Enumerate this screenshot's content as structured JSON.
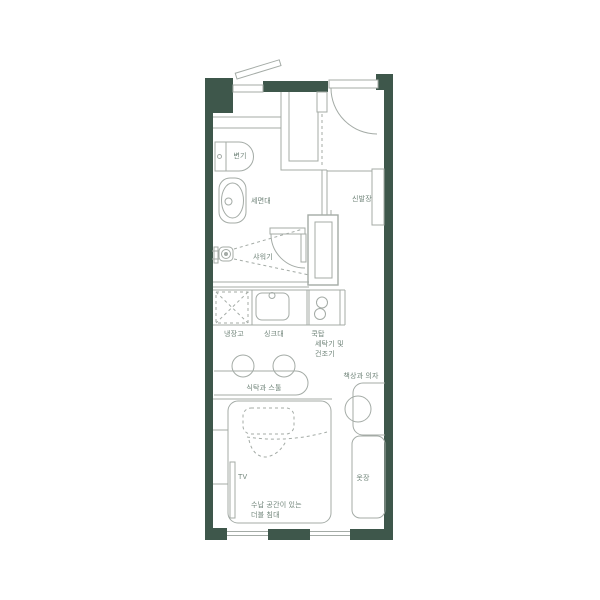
{
  "title": "studio-apartment-floor-plan",
  "colors": {
    "wall": "#3E574B",
    "line": "#A4ABA6",
    "text": "#6F8378",
    "background": "#FFFFFF"
  },
  "labels": {
    "toilet": "변기",
    "washbasin": "세면대",
    "shower": "샤워기",
    "shoe_cabinet": "신발장",
    "refrigerator": "냉장고",
    "kitchen_sink": "싱크대",
    "cooktop": "쿡탑",
    "washer_dryer_line1": "세탁기 및",
    "washer_dryer_line2": "건조기",
    "dining": "식탁과 스툴",
    "desk_chair": "책상과 의자",
    "tv": "TV",
    "bed_line1": "수납 공간이 있는",
    "bed_line2": "더블 침대",
    "wardrobe": "옷장"
  }
}
